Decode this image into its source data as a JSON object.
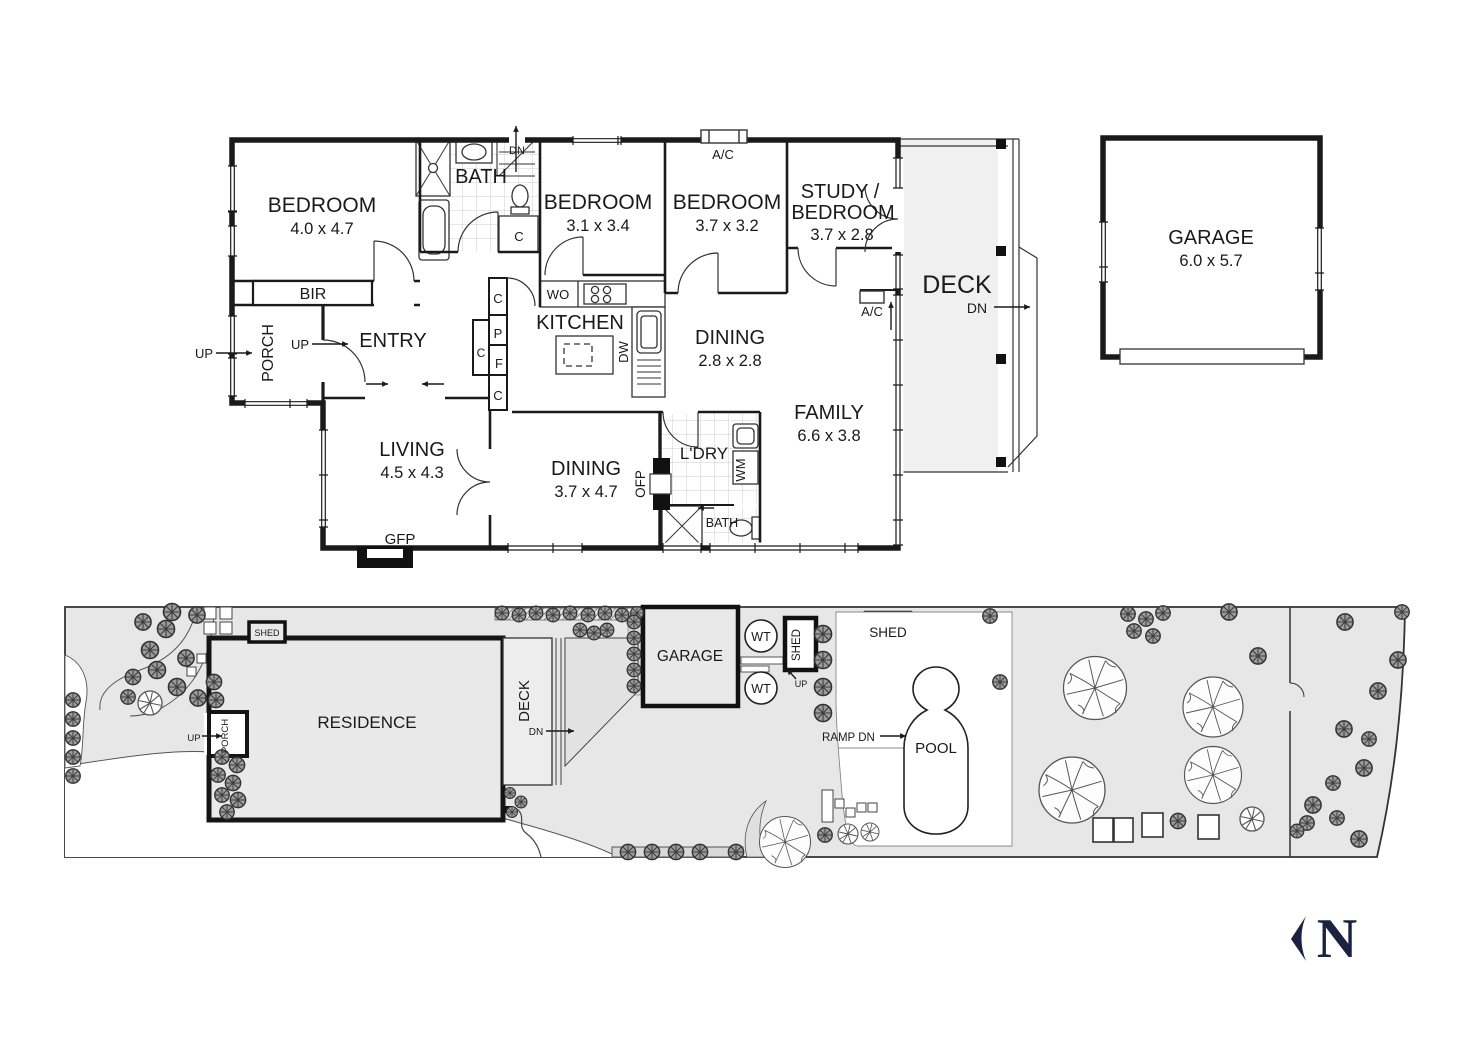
{
  "floorplan": {
    "bedroom1": {
      "name": "BEDROOM",
      "dims": "4.0 x 4.7"
    },
    "bedroom2": {
      "name": "BEDROOM",
      "dims": "3.1 x 3.4"
    },
    "bedroom3": {
      "name": "BEDROOM",
      "dims": "3.7 x 3.2"
    },
    "study": {
      "line1": "STUDY /",
      "line2": "BEDROOM",
      "dims": "3.7 x 2.8"
    },
    "bath1": "BATH",
    "bath2": "BATH",
    "dn_stair": "DN",
    "deck": {
      "name": "DECK",
      "dn": "DN"
    },
    "ac1": "A/C",
    "ac2": "A/C",
    "bir": "BIR",
    "porch": "PORCH",
    "up_outer": "UP",
    "up_porch": "UP",
    "entry": "ENTRY",
    "kitchen": {
      "name": "KITCHEN",
      "wo": "WO",
      "dw": "DW"
    },
    "dining1": {
      "name": "DINING",
      "dims": "2.8 x 2.8"
    },
    "family": {
      "name": "FAMILY",
      "dims": "6.6 x 3.8"
    },
    "living": {
      "name": "LIVING",
      "dims": "4.5 x 4.3"
    },
    "dining2": {
      "name": "DINING",
      "dims": "3.7 x 4.7"
    },
    "gfp": "GFP",
    "ofp": "OFP",
    "ldry": "L'DRY",
    "wm": "WM",
    "closets": {
      "c1": "C",
      "c2": "C",
      "p": "P",
      "c3": "C",
      "f": "F",
      "c4": "C"
    }
  },
  "garage_detached": {
    "name": "GARAGE",
    "dims": "6.0 x 5.7"
  },
  "siteplan": {
    "residence": "RESIDENCE",
    "porch": "PORCH",
    "up1": "UP",
    "deck": "DECK",
    "deck_dn": "DN",
    "garage": "GARAGE",
    "wt1": "WT",
    "wt2": "WT",
    "shed1": "SHED",
    "shed2": "SHED",
    "shed2_up": "UP",
    "shed3": "SHED",
    "ramp": "RAMP DN",
    "pool": "POOL"
  },
  "north": {
    "n": "N"
  }
}
